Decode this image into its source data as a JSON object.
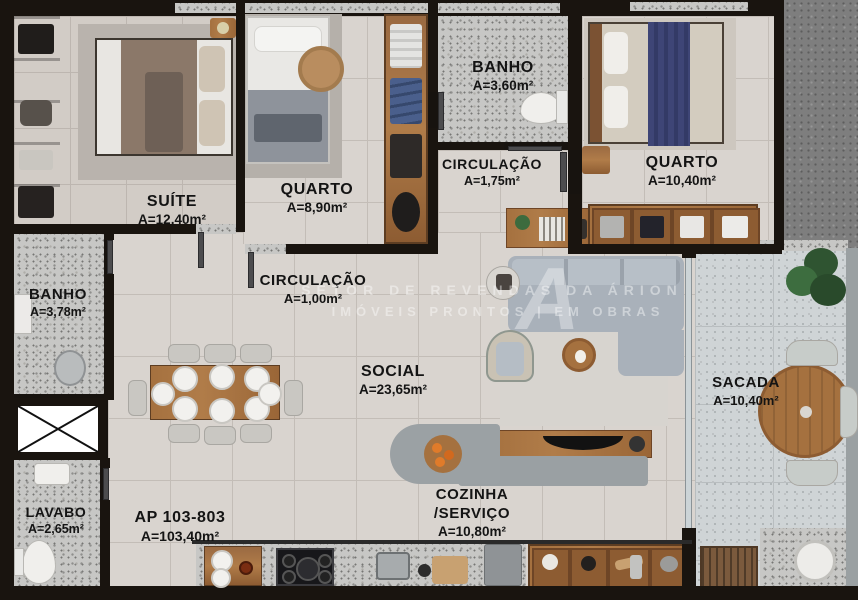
{
  "unit": {
    "code": "AP 103-803",
    "area": "A=103,40m²"
  },
  "rooms": {
    "suite": {
      "name": "SUÍTE",
      "area": "A=12,40m²"
    },
    "quarto1": {
      "name": "QUARTO",
      "area": "A=8,90m²"
    },
    "banho1": {
      "name": "BANHO",
      "area": "A=3,60m²"
    },
    "circulacao1": {
      "name": "CIRCULAÇÃO",
      "area": "A=1,75m²"
    },
    "quarto2": {
      "name": "QUARTO",
      "area": "A=10,40m²"
    },
    "circulacao2": {
      "name": "CIRCULAÇÃO",
      "area": "A=1,00m²"
    },
    "banho2": {
      "name": "BANHO",
      "area": "A=3,78m²"
    },
    "social": {
      "name": "SOCIAL",
      "area": "A=23,65m²"
    },
    "lavabo": {
      "name": "LAVABO",
      "area": "A=2,65m²"
    },
    "cozinha": {
      "name": "COZINHA",
      "name2": "/SERVIÇO",
      "area": "A=10,80m²"
    },
    "sacada": {
      "name": "SACADA",
      "area": "A=10,40m²"
    }
  },
  "watermark": {
    "line1": "SETOR DE REVENDAS DA ÁRION",
    "line2": "IMÓVEIS PRONTOS | EM OBRAS",
    "logo": "A"
  },
  "colors": {
    "wall": "#19140f",
    "floor": "#d9d4cf",
    "granite": "#c7c7c5",
    "wood": "#a5713f",
    "accent_blue": "#3e4576"
  }
}
